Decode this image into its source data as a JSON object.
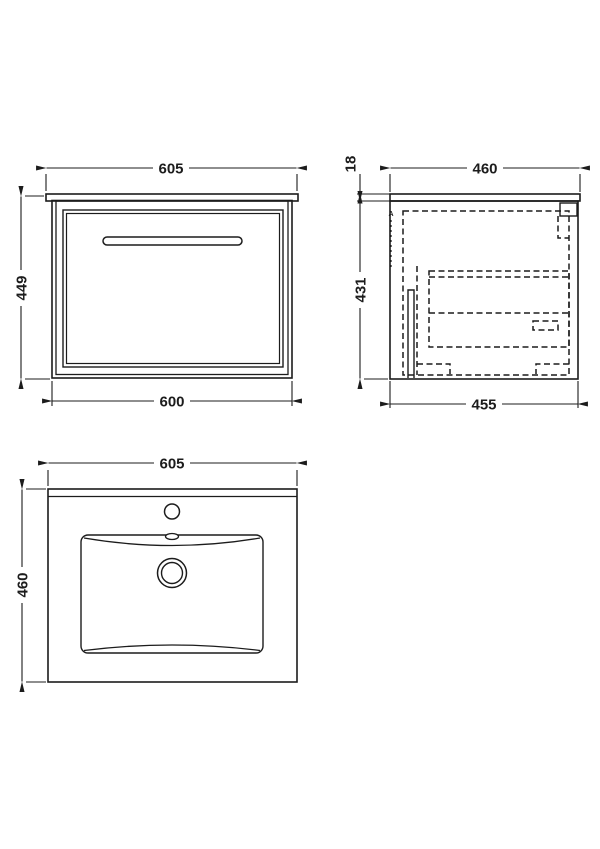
{
  "drawing": {
    "background_color": "#ffffff",
    "line_color": "#1c1c1c"
  },
  "views": {
    "front": {
      "dims": {
        "width_top": "605",
        "height": "449",
        "width_bottom": "600"
      }
    },
    "side": {
      "marker": "A",
      "dims": {
        "depth_top": "460",
        "counter_thickness": "18",
        "height": "431",
        "depth_bottom": "455"
      }
    },
    "plan": {
      "dims": {
        "width": "605",
        "depth": "460"
      }
    }
  }
}
